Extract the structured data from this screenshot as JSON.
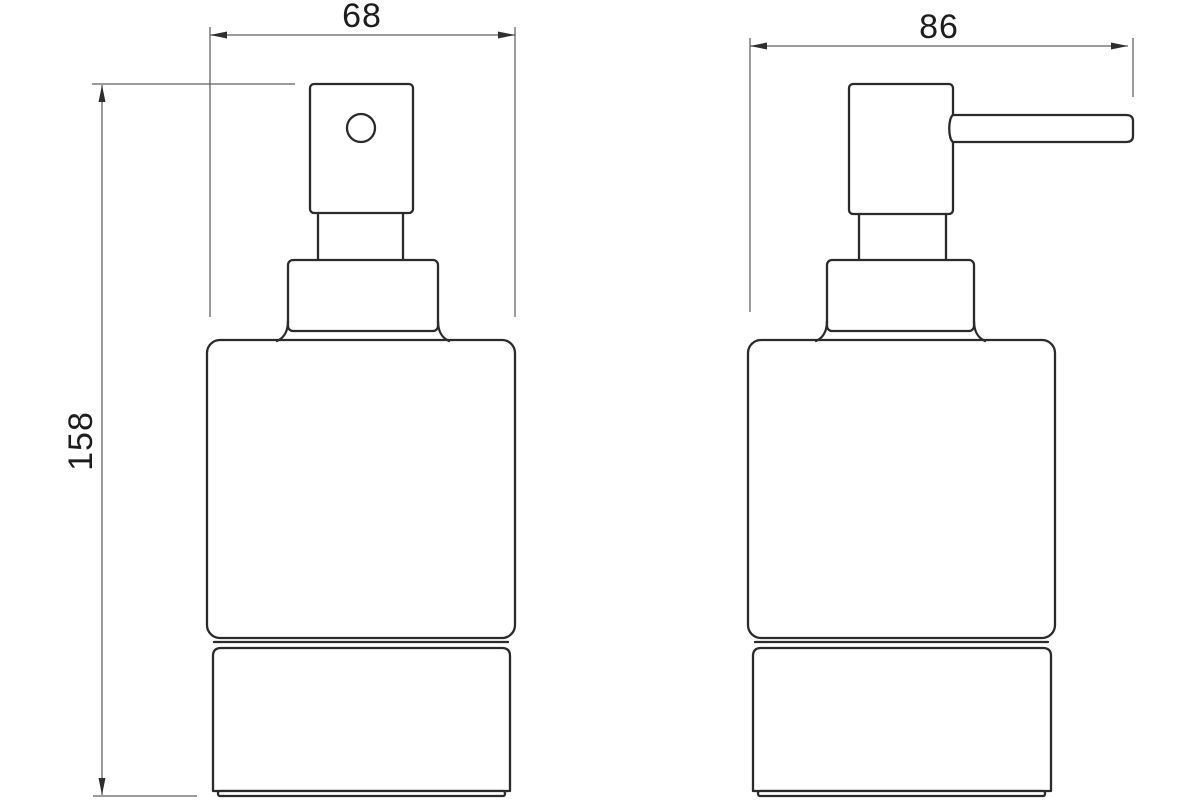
{
  "drawing": {
    "title": "Soap dispenser technical drawing",
    "views": {
      "front": {
        "name": "front-view"
      },
      "side": {
        "name": "side-view"
      }
    },
    "dimensions": {
      "front_width": "68",
      "side_depth": "86",
      "height": "158"
    },
    "colors": {
      "background": "#ffffff",
      "object_line": "#2b2b2b",
      "dimension_line": "#5f5f5f",
      "text": "#1d1d1d"
    }
  }
}
